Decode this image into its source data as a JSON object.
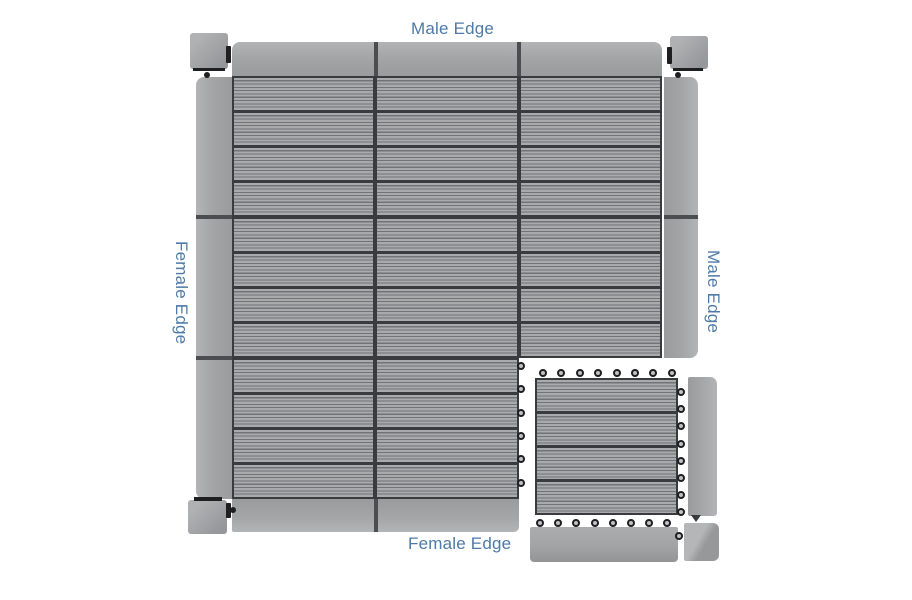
{
  "labels": {
    "top": "Male Edge",
    "left": "Female Edge",
    "right": "Male Edge",
    "bottom": "Female Edge"
  },
  "colors": {
    "background": "#ffffff",
    "label_blue": "#4d7aa6",
    "plank_light": "#a9aaac",
    "plank_groove": "#727377",
    "grid_dark": "#3a3b3e",
    "strip_light": "#b3b4b6",
    "strip_shade": "#9a9b9d",
    "connector_black": "#1f1f22"
  },
  "assembly": {
    "tile_rows": 3,
    "tile_cols": 3,
    "missing_tile_row": 3,
    "missing_tile_col": 3,
    "planks_per_tile": 4,
    "edge_strip_sides": [
      "top",
      "left",
      "right",
      "bottom"
    ],
    "corner_piece_positions": [
      "top-left",
      "top-right",
      "bottom-left"
    ]
  },
  "exploded_parts": {
    "single_tile": "deck tile",
    "vertical_piece": "side edge strip",
    "horizontal_piece": "bottom edge strip",
    "corner_piece": "corner trim"
  },
  "connectors": {
    "grid_exposed_right_loops": 6,
    "single_tile_top_loops": 8,
    "single_tile_right_loops": 8,
    "bottom_strip_top_loops": 8,
    "bottom_strip_right_loops": 1
  }
}
